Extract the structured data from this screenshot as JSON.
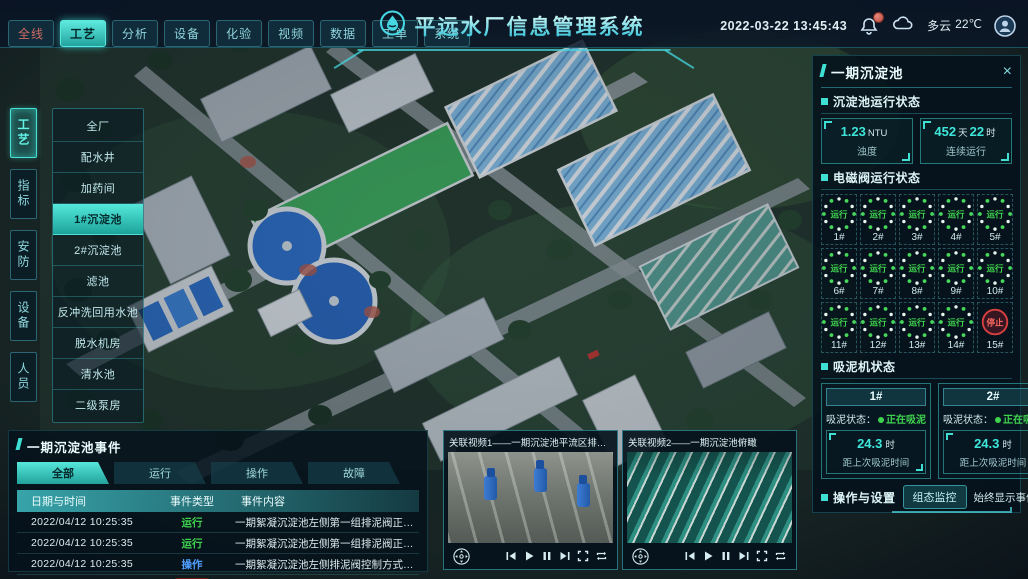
{
  "app": {
    "title": "平远水厂信息管理系统",
    "datetime": "2022-03-22 13:45:43",
    "weather": {
      "condition": "多云",
      "temperature": "22℃"
    },
    "close_label": "×"
  },
  "colors": {
    "accent": "#3fe0d4",
    "running_green": "#45d455",
    "fault_red": "#e0564a",
    "op_blue": "#4f9eff"
  },
  "top_nav": {
    "tabs": [
      {
        "label": "全线",
        "cls": "alert"
      },
      {
        "label": "工艺",
        "cls": "active"
      },
      {
        "label": "分析",
        "cls": ""
      },
      {
        "label": "设备",
        "cls": ""
      },
      {
        "label": "化验",
        "cls": ""
      },
      {
        "label": "视频",
        "cls": ""
      },
      {
        "label": "数据",
        "cls": ""
      },
      {
        "label": "工单",
        "cls": ""
      },
      {
        "label": "系统",
        "cls": ""
      }
    ]
  },
  "sidebar": {
    "tabs": [
      {
        "label": "工艺",
        "cls": "active"
      },
      {
        "label": "指标",
        "cls": ""
      },
      {
        "label": "安防",
        "cls": ""
      },
      {
        "label": "设备",
        "cls": ""
      },
      {
        "label": "人员",
        "cls": ""
      }
    ]
  },
  "process_menu": {
    "items": [
      {
        "label": "全厂",
        "cls": ""
      },
      {
        "label": "配水井",
        "cls": ""
      },
      {
        "label": "加药间",
        "cls": ""
      },
      {
        "label": "1#沉淀池",
        "cls": "active"
      },
      {
        "label": "2#沉淀池",
        "cls": ""
      },
      {
        "label": "滤池",
        "cls": ""
      },
      {
        "label": "反冲洗回用水池",
        "cls": ""
      },
      {
        "label": "脱水机房",
        "cls": ""
      },
      {
        "label": "清水池",
        "cls": ""
      },
      {
        "label": "二级泵房",
        "cls": ""
      }
    ]
  },
  "right_panel": {
    "title": "一期沉淀池",
    "run_status": {
      "title": "沉淀池运行状态",
      "stats": [
        {
          "num1": "1.23",
          "unit1": "NTU",
          "num2": "",
          "unit2": "",
          "label": "浊度"
        },
        {
          "num1": "452",
          "unit1": "天",
          "num2": "22",
          "unit2": "时",
          "label": "连续运行"
        }
      ]
    },
    "valves": {
      "title": "电磁阀运行状态",
      "items": [
        {
          "label": "1#",
          "status": "运行",
          "cls": "running"
        },
        {
          "label": "2#",
          "status": "运行",
          "cls": "running"
        },
        {
          "label": "3#",
          "status": "运行",
          "cls": "running"
        },
        {
          "label": "4#",
          "status": "运行",
          "cls": "running"
        },
        {
          "label": "5#",
          "status": "运行",
          "cls": "running"
        },
        {
          "label": "6#",
          "status": "运行",
          "cls": "running"
        },
        {
          "label": "7#",
          "status": "运行",
          "cls": "running"
        },
        {
          "label": "8#",
          "status": "运行",
          "cls": "running"
        },
        {
          "label": "9#",
          "status": "运行",
          "cls": "running"
        },
        {
          "label": "10#",
          "status": "运行",
          "cls": "running"
        },
        {
          "label": "11#",
          "status": "运行",
          "cls": "running"
        },
        {
          "label": "12#",
          "status": "运行",
          "cls": "running"
        },
        {
          "label": "13#",
          "status": "运行",
          "cls": "running"
        },
        {
          "label": "14#",
          "status": "运行",
          "cls": "running"
        },
        {
          "label": "15#",
          "status": "停止",
          "cls": "stopped"
        }
      ]
    },
    "scrapers": {
      "title": "吸泥机状态",
      "items": [
        {
          "name": "1#",
          "status_label": "吸泥状态：",
          "status": "正在吸泥",
          "value": "24.3",
          "unit": "时",
          "caption": "距上次吸泥时间"
        },
        {
          "name": "2#",
          "status_label": "吸泥状态：",
          "status": "正在吸泥",
          "value": "24.3",
          "unit": "时",
          "caption": "距上次吸泥时间"
        }
      ]
    },
    "operations": {
      "title": "操作与设置",
      "monitor_button": "组态监控",
      "toggle_label": "始终显示事件：",
      "toggle_on": true
    }
  },
  "events": {
    "title": "一期沉淀池事件",
    "tabs": [
      {
        "label": "全部",
        "cls": "active"
      },
      {
        "label": "运行",
        "cls": ""
      },
      {
        "label": "操作",
        "cls": ""
      },
      {
        "label": "故障",
        "cls": ""
      }
    ],
    "columns": [
      "日期与时间",
      "事件类型",
      "事件内容"
    ],
    "rows": [
      {
        "time": "2022/04/12 10:25:35",
        "type": "运行",
        "cls": "type-run",
        "content": "一期絮凝沉淀池左侧第一组排泥阀正在排泥"
      },
      {
        "time": "2022/04/12 10:25:35",
        "type": "运行",
        "cls": "type-run",
        "content": "一期絮凝沉淀池左侧第一组排泥阀正在排泥"
      },
      {
        "time": "2022/04/12 10:25:35",
        "type": "操作",
        "cls": "type-op",
        "content": "一期絮凝沉淀池左侧排泥阀控制方式切换为手动"
      },
      {
        "time": "2022/04/12 10:25:35",
        "type": "故障",
        "cls": "type-fault",
        "content": "一期絮凝沉淀池左侧第二组排泥阀启动失败"
      }
    ]
  },
  "videos": {
    "panels": [
      {
        "title": "关联视频1——一期沉淀池平流区排泥管廊",
        "scene": "scene-pumps"
      },
      {
        "title": "关联视频2——一期沉淀池俯瞰",
        "scene": "scene-basins"
      }
    ]
  }
}
